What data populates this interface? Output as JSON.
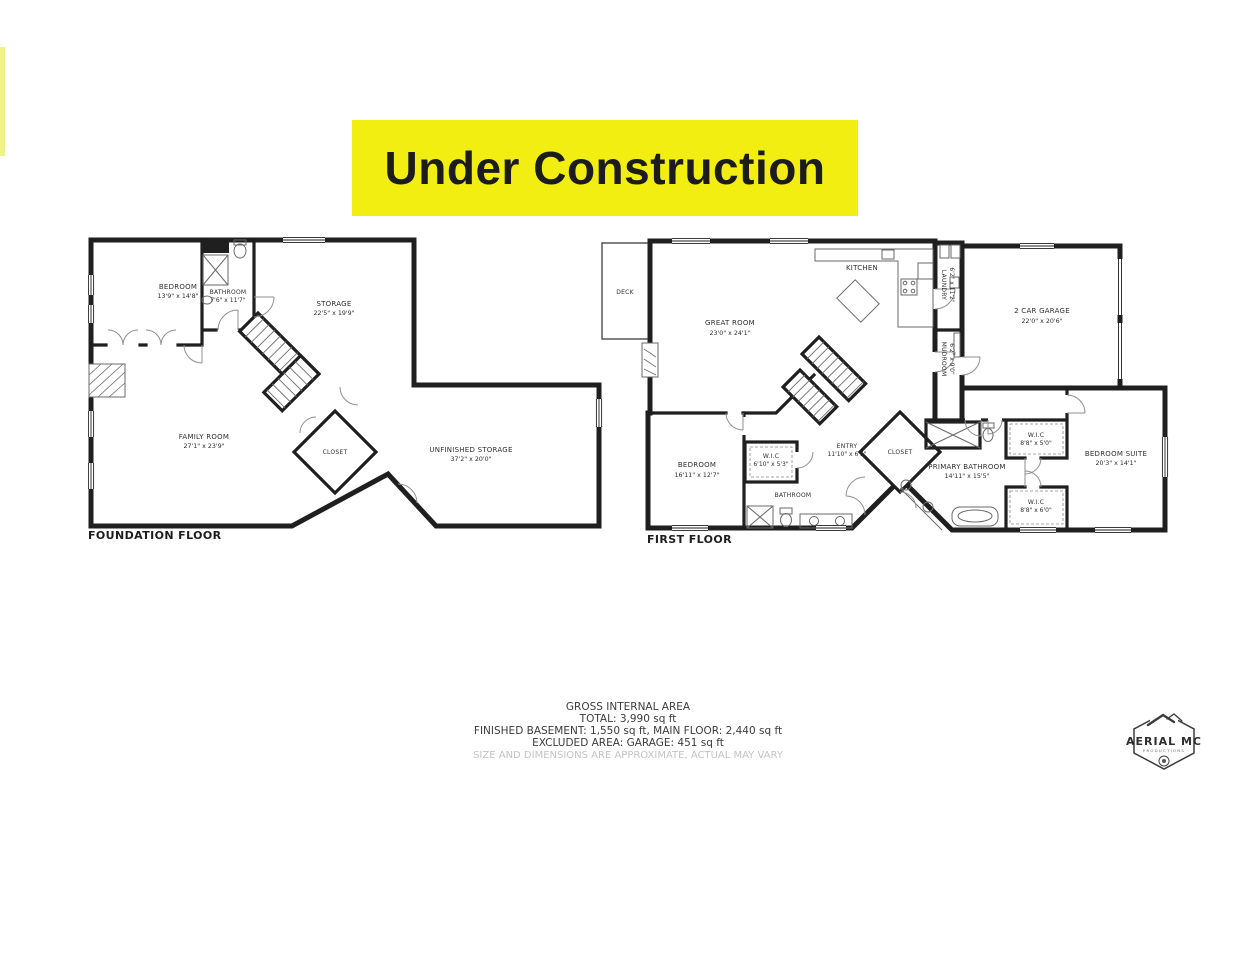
{
  "banner": {
    "text": "Under Construction"
  },
  "colors": {
    "banner_bg": "#f2ee12",
    "banner_text": "#1c1c1e",
    "left_stripe": "#eff189",
    "wall": "#1f1f1f"
  },
  "plans": [
    {
      "caption": "FOUNDATION FLOOR",
      "rooms": [
        {
          "name": "BEDROOM",
          "dims": "13'9\" x 14'8\""
        },
        {
          "name": "BATHROOM",
          "dims": "7'6\" x 11'7\""
        },
        {
          "name": "STORAGE",
          "dims": "22'5\" x 19'9\""
        },
        {
          "name": "FAMILY ROOM",
          "dims": "27'1\" x 23'9\""
        },
        {
          "name": "CLOSET",
          "dims": ""
        },
        {
          "name": "UNFINISHED STORAGE",
          "dims": "37'2\" x 20'0\""
        }
      ]
    },
    {
      "caption": "FIRST FLOOR",
      "rooms": [
        {
          "name": "DECK",
          "dims": ""
        },
        {
          "name": "GREAT ROOM",
          "dims": "23'0\" x 24'1\""
        },
        {
          "name": "KITCHEN",
          "dims": ""
        },
        {
          "name": "LAUNDRY",
          "dims": "6'2\" x 11'2\""
        },
        {
          "name": "MUDROOM",
          "dims": "6'2\" x 9'0\""
        },
        {
          "name": "2 CAR GARAGE",
          "dims": "22'0\" x 20'6\""
        },
        {
          "name": "BEDROOM",
          "dims": "16'11\" x 12'7\""
        },
        {
          "name": "W.I.C",
          "dims": "6'10\" x 5'3\""
        },
        {
          "name": "ENTRY",
          "dims": "11'10\" x 6'5\""
        },
        {
          "name": "BATHROOM",
          "dims": ""
        },
        {
          "name": "CLOSET",
          "dims": ""
        },
        {
          "name": "PRIMARY BATHROOM",
          "dims": "14'11\" x 15'5\""
        },
        {
          "name": "W.I.C",
          "dims": "8'8\" x 5'0\""
        },
        {
          "name": "W.I.C",
          "dims": "8'8\" x 6'0\""
        },
        {
          "name": "BEDROOM SUITE",
          "dims": "20'3\" x 14'1\""
        }
      ]
    }
  ],
  "summary": {
    "title": "GROSS INTERNAL AREA",
    "total": "TOTAL: 3,990 sq ft",
    "breakdown": "FINISHED BASEMENT: 1,550 sq ft, MAIN FLOOR: 2,440 sq ft",
    "excluded": "EXCLUDED AREA: GARAGE: 451 sq ft",
    "disclaimer": "SIZE AND DIMENSIONS ARE APPROXIMATE, ACTUAL MAY VARY"
  },
  "logo": {
    "brand": "AERIAL MC",
    "sub": "PRODUCTIONS"
  }
}
